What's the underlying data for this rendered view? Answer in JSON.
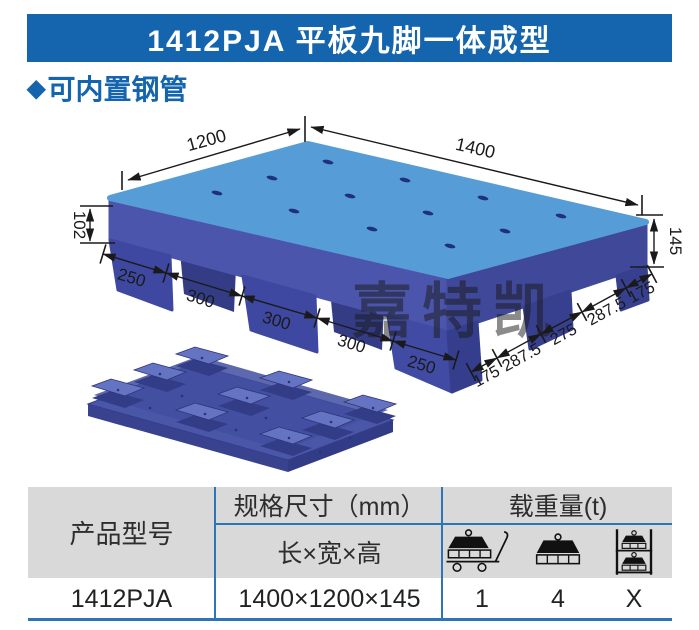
{
  "header": {
    "title": "1412PJA 平板九脚一体成型",
    "bg_color": "#1565AE",
    "text_color": "#ffffff"
  },
  "subtitle": {
    "bullet": "◆",
    "text": "可内置钢管",
    "color": "#1565AE"
  },
  "drawing": {
    "watermark": "嘉特凯",
    "watermark_color": "#909090",
    "pallet_colors": {
      "top": "#569CD6",
      "side_left": "#4B55AB",
      "side_right": "#3F4899",
      "feet": "#3E48A0"
    },
    "dims": {
      "top_width": "1200",
      "top_length": "1400",
      "deck_height": "102",
      "total_height": "145",
      "bottom_left_chain": [
        "250",
        "300",
        "300",
        "300",
        "250"
      ],
      "bottom_right_chain": [
        "175",
        "287.5",
        "275",
        "287.5",
        "175"
      ]
    }
  },
  "table": {
    "header_bg": "#D9D9D9",
    "border_color": "#2E75B5",
    "header": {
      "model": "产品型号",
      "spec": "规格尺寸（mm）",
      "spec_sub": "长×宽×高",
      "load": "载重量(t)"
    },
    "load_icons": [
      "dynamic-load",
      "static-load",
      "rack-load"
    ],
    "row": {
      "model": "1412PJA",
      "size": "1400×1200×145",
      "load_dynamic": "1",
      "load_static": "4",
      "load_rack": "X"
    }
  }
}
